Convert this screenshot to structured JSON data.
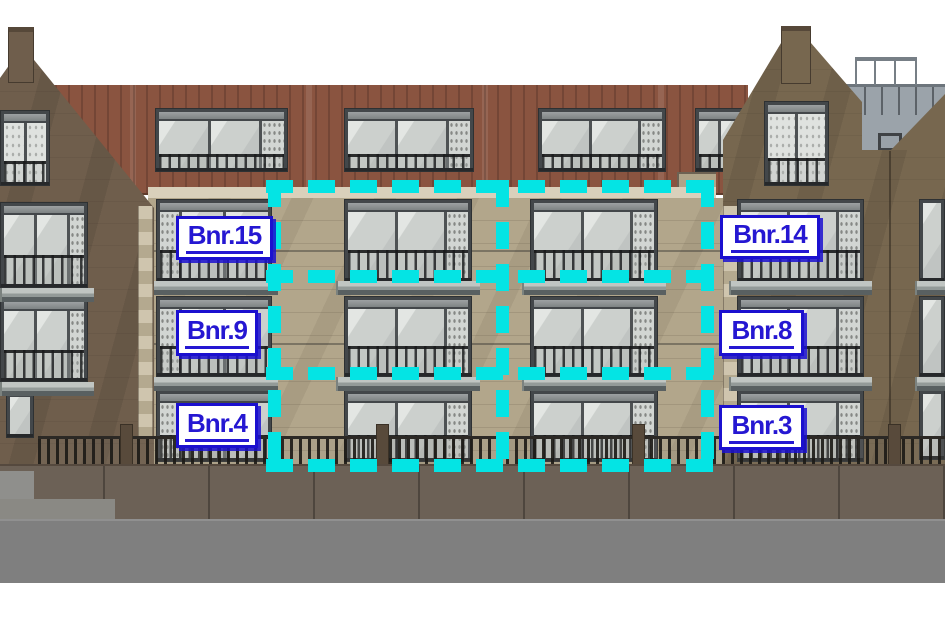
{
  "scene": {
    "type": "building-elevation",
    "description": "Front elevation of apartment building with unit selection overlay"
  },
  "overlay": {
    "accent_color": "#04e4e4",
    "rows": 3,
    "cols": 2,
    "cells": [
      {
        "row": 1,
        "col": 1,
        "apartment": "Bnr.15"
      },
      {
        "row": 1,
        "col": 2,
        "apartment": "Bnr.14"
      },
      {
        "row": 2,
        "col": 1,
        "apartment": "Bnr.9"
      },
      {
        "row": 2,
        "col": 2,
        "apartment": "Bnr.8"
      },
      {
        "row": 3,
        "col": 1,
        "apartment": "Bnr.4"
      },
      {
        "row": 3,
        "col": 2,
        "apartment": "Bnr.3"
      }
    ]
  },
  "labels": [
    {
      "id": "bnr15",
      "text": "Bnr.15"
    },
    {
      "id": "bnr14",
      "text": "Bnr.14"
    },
    {
      "id": "bnr9",
      "text": "Bnr.9"
    },
    {
      "id": "bnr8",
      "text": "Bnr.8"
    },
    {
      "id": "bnr4",
      "text": "Bnr.4"
    },
    {
      "id": "bnr3",
      "text": "Bnr.3"
    }
  ],
  "label_style": {
    "text_color": "#2517d2",
    "border_color": "#1b10cf",
    "background": "#ffffff"
  },
  "palette": {
    "sky": "#ffffff",
    "tower_brick": "#6e5d4b",
    "attic_cladding": "#8a5440",
    "facade_stone": "#b2a68b",
    "cornice": "#d9d0bb",
    "window_frame": "#4e5254",
    "glass": "#cdd1ce",
    "balcony_slab": "#a7adab",
    "fence_wall": "#6c6156",
    "ground": "#7f7f7f"
  }
}
